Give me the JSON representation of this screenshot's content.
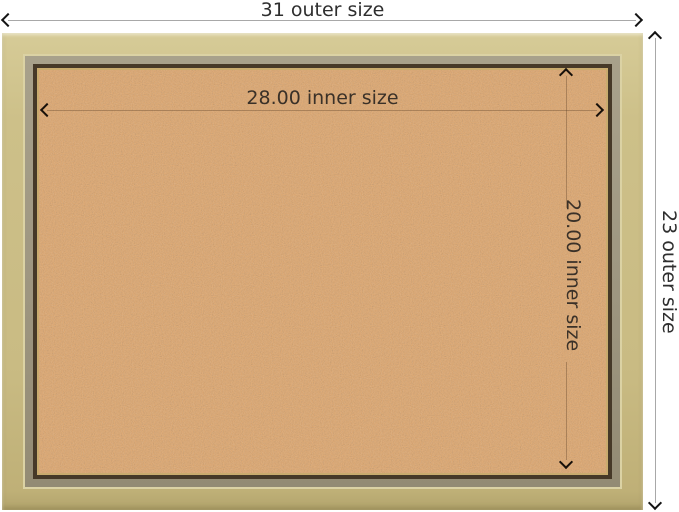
{
  "annotations": {
    "outer_width": {
      "value": 31,
      "label": "31 outer size"
    },
    "outer_height": {
      "value": 23,
      "label": "23 outer size"
    },
    "inner_width": {
      "value": 28.0,
      "label": "28.00 inner size"
    },
    "inner_height": {
      "value": 20.0,
      "label": "20.00 inner size"
    }
  },
  "colors": {
    "background": "#ffffff",
    "frame_champagne": "#cabc84",
    "frame_ridge_light": "#dbd2a4",
    "frame_step_olive": "#9e9680",
    "frame_lip_bronze": "#463928",
    "frame_inner_gold": "#c9ab6e",
    "cork_base": "#e0a76e",
    "dimension_line": "#a8a8a8",
    "arrow": "#141414",
    "label_text": "#2e2e2e"
  }
}
